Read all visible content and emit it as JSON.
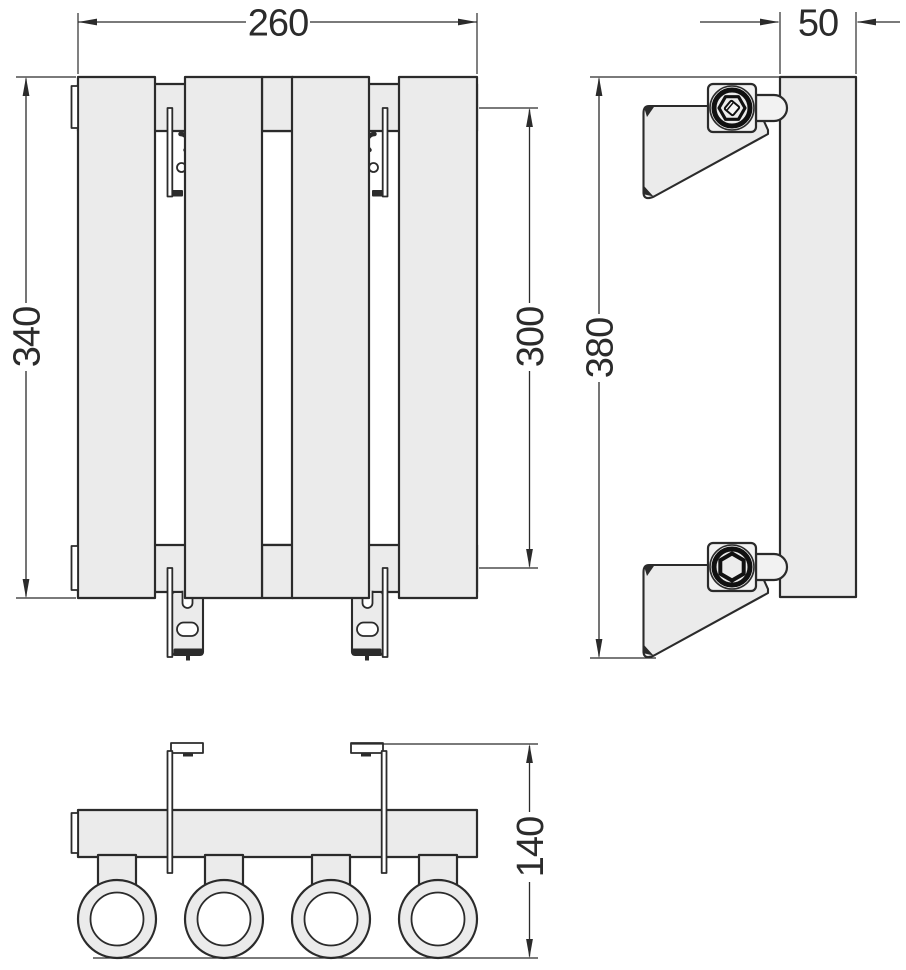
{
  "dimensions": {
    "front_width": "260",
    "front_height": "340",
    "front_port_spacing": "300",
    "side_depth": "50",
    "side_height": "380",
    "bottom_height": "140"
  },
  "colors": {
    "part_fill": "#ebebeb",
    "line": "#2b2b2b",
    "background": "#ffffff"
  }
}
